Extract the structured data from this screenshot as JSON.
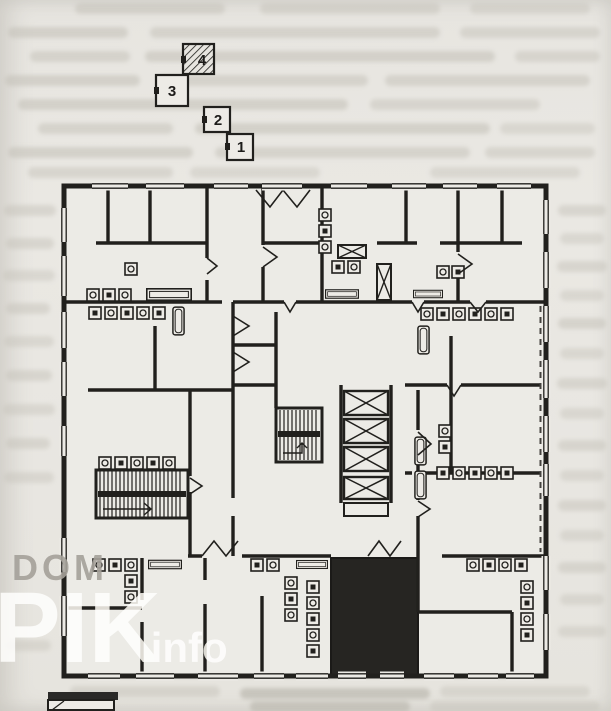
{
  "page": {
    "kind": "scanned floor plan page",
    "background_color": "#e8e6e1",
    "ink_color": "#21201d"
  },
  "legend": {
    "units": [
      {
        "label": "1",
        "style": "plain"
      },
      {
        "label": "2",
        "style": "plain"
      },
      {
        "label": "3",
        "style": "plain"
      },
      {
        "label": "4",
        "style": "hatched"
      }
    ]
  },
  "watermark": {
    "word1": "DOM",
    "word2": "PIK",
    "word3": "info",
    "color": "#a5a19a"
  },
  "plan": {
    "type": "residential-tower-floor-plan",
    "elevator_shaft_count": 4,
    "staircase_count": 2,
    "ventilation_shaft_count": 2,
    "highlighted_room_style": "solid-black-fill"
  }
}
